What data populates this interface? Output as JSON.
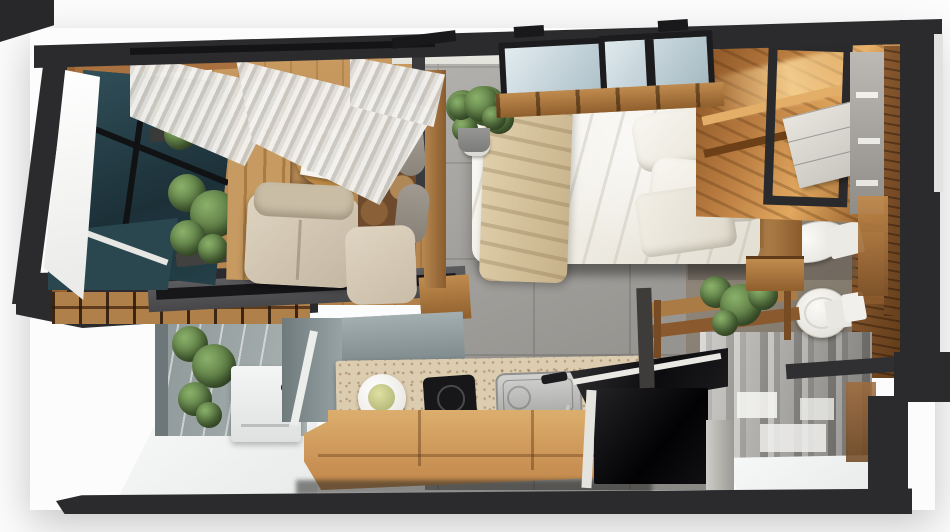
{
  "meta": {
    "title": "3D rendered top-down floor plan of a studio apartment",
    "view": "overhead cutaway render",
    "canvas": {
      "width": 950,
      "height": 532
    }
  },
  "palette": {
    "wall": "#2b2b2d",
    "wall_corner": "#28282a",
    "tile_floor": "#a09e99",
    "wood_floor": "#c0905a",
    "wood_frame": "#a9773f",
    "wood_rich": "#8a5a30",
    "wood_glow": "#e2a85f",
    "terrazzo": "#ddcdb0",
    "bench_wood": "#d3a367",
    "bed_linen": "#f6f4ee",
    "throw_blanket": "#d5c29c",
    "pillow_gray": "#a29c93",
    "plant_green": "#5c7c44",
    "skylight_glass": "#b9cbd4",
    "window_glass": "#22383f",
    "curtain_light": "#f3f2ef",
    "concrete": "#97a0a0",
    "white_floor": "#f3f5f5",
    "island_black": "#0e0e10",
    "steel_sink": "#c0c0be",
    "mirror_gray": "#a5a3a0",
    "porcelain": "#f4f3ee",
    "bathroom_floor": "#877d71",
    "armchair_beige": "#d6cab5",
    "gloss_black": "#17171a"
  },
  "scene": {
    "rooms": [
      {
        "name": "living-area",
        "items": [
          "corner window",
          "sheer curtains",
          "two potted plants",
          "wood slat door panels",
          "round wood coffee table",
          "open magazine with plate",
          "beige lounge chair",
          "wood-framed bench sofa with patterned cushions and gray pillows"
        ]
      },
      {
        "name": "sleeping-area",
        "items": [
          "double bed with white duvet",
          "beige throw blanket",
          "three white pillows",
          "upholstered headboard",
          "wood platform",
          "bedside plant",
          "two black-framed skylight windows"
        ]
      },
      {
        "name": "wardrobe-nook",
        "items": [
          "walnut closet with warm accent lighting",
          "black metal display frame",
          "white drawer cabinet"
        ]
      },
      {
        "name": "bathroom",
        "items": [
          "wall-hung basin",
          "toilet with cistern",
          "paper holder",
          "wood shelf with potted plant"
        ]
      },
      {
        "name": "kitchen",
        "items": [
          "terrazzo countertop",
          "white serving plate",
          "black induction hob",
          "stainless sink with pull-out faucet",
          "light wood bench drawers"
        ]
      },
      {
        "name": "island",
        "items": [
          "black stone counter with white edge",
          "black appliance front",
          "gray pillar"
        ]
      },
      {
        "name": "entry-balcony",
        "items": [
          "concrete feature wall",
          "hanging plant",
          "white storage unit",
          "white sloped floor"
        ]
      },
      {
        "name": "mirrored-closet",
        "items": [
          "reflective wardrobe front",
          "white shelf boxes",
          "wood reflection"
        ]
      }
    ]
  }
}
